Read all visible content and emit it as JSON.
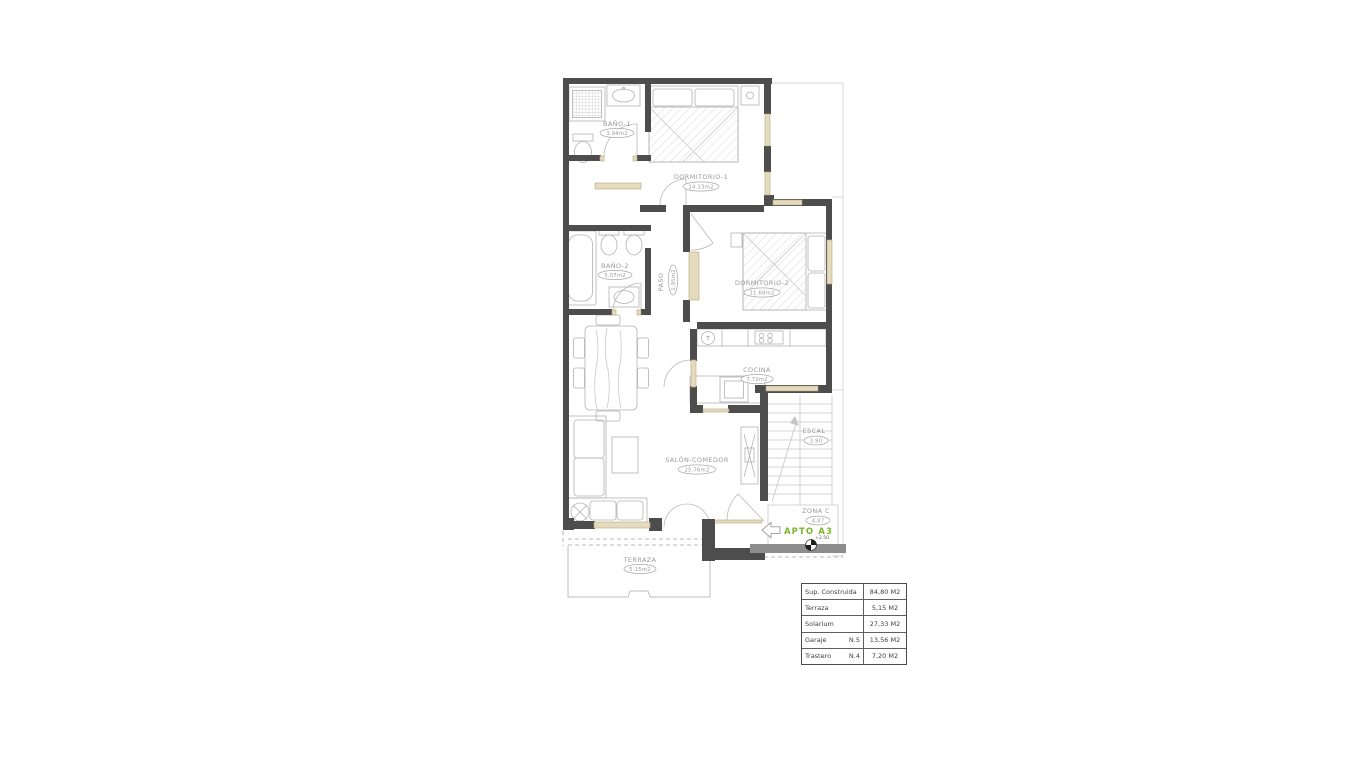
{
  "plan": {
    "apto_label": "APTO A3",
    "level_mark": "+2.50",
    "kitchen_boiler_label": "T",
    "colors": {
      "wall": "#4d4d4d",
      "lintel": "#e5dcc0",
      "accent_green": "#76b82a",
      "furniture_line": "#b2b2b2",
      "label_gray": "#9b9b9b"
    },
    "rooms": [
      {
        "name": "BAÑO-1",
        "area": "3.94m2"
      },
      {
        "name": "DORMITORIO-1",
        "area": "14.13m2"
      },
      {
        "name": "BAÑO-2",
        "area": "5.07m2"
      },
      {
        "name": "PASO",
        "area": "1.95m2"
      },
      {
        "name": "DORMITORIO-2",
        "area": "11.68m2"
      },
      {
        "name": "COCINA",
        "area": "7.72m2"
      },
      {
        "name": "SALÓN-COMEDOR",
        "area": "25.76m2"
      },
      {
        "name": "TERRAZA",
        "area": "5.15m2"
      },
      {
        "name": "ESCAL",
        "area": "3.90"
      },
      {
        "name": "ZONA C",
        "area": "4.87"
      }
    ]
  },
  "summary_table": {
    "rows": [
      {
        "label": "Sup. Construida",
        "unit": "",
        "value": "84,80 M2"
      },
      {
        "label": "Terraza",
        "unit": "",
        "value": "5,15 M2"
      },
      {
        "label": "Solarium",
        "unit": "",
        "value": "27,33 M2"
      },
      {
        "label": "Garaje",
        "unit": "N.5",
        "value": "13,56 M2"
      },
      {
        "label": "Trastero",
        "unit": "N.4",
        "value": "7,20 M2"
      }
    ]
  }
}
